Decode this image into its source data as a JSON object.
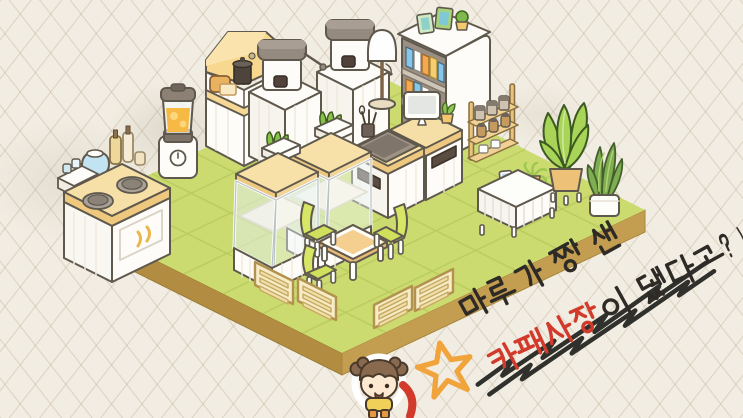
{
  "scene": {
    "description": "Isometric cafe room built on cream grid paper",
    "background_color": "#f2ede2",
    "floor": {
      "top_color": "#cbdb70",
      "tile_line_color": "#b9c95d",
      "edge_left_color": "#b28d41",
      "edge_right_color": "#c49e50"
    }
  },
  "furniture": {
    "stove_counter": "two-burner stove counter with kettle, cups and syrup bottles",
    "blender": "blender filled with orange juice",
    "bread_station": "bread prep station with range hood, toast, pot and grill",
    "coffee_station": "two espresso machines on white cabinets",
    "bookshelf": "white bookshelf with books, two picture frames and a cactus",
    "floor_lamp": "floor lamp with white shade",
    "service_counter": "service counter with sink, utensils, monitor and mini plant",
    "jar_shelf": "wooden rack with coffee jars and cups",
    "display_case_back": "glass bakery display case with grass planter on top",
    "display_case_front": "glass bakery display case with grass planter on top",
    "sideboard": "white slatted sideboard with photo frame and mini palm",
    "potted_plant_large": "large leafy plant in tan pot on stand",
    "snake_plant": "snake plant in white pot",
    "cafe_table": "square cafe table with white rim",
    "chair_back_left": "lime green chair",
    "chair_front_left": "lime green chair",
    "chair_right": "lime green chair",
    "fence_left_1": "wooden slat fence panel",
    "fence_left_2": "wooden slat fence panel",
    "fence_right_1": "wooden slat fence panel",
    "fence_right_2": "wooden slat fence panel"
  },
  "character": {
    "label": "girl character with double hair buns, yellow top and orange pants",
    "hair_color": "#8a6a4e",
    "shirt_color": "#f0d058",
    "pants_color": "#e7973f"
  },
  "annotation": {
    "line1": "마루가 짱 센",
    "line2_highlight": "카페사장",
    "line2_rest": "이 됐다고?!",
    "full_text": "마루가 짱 센 카페사장이 됐다고?!",
    "ink_color": "#2e2b27",
    "highlight_color": "#d23a2c",
    "star_color": "#f1a33c"
  }
}
